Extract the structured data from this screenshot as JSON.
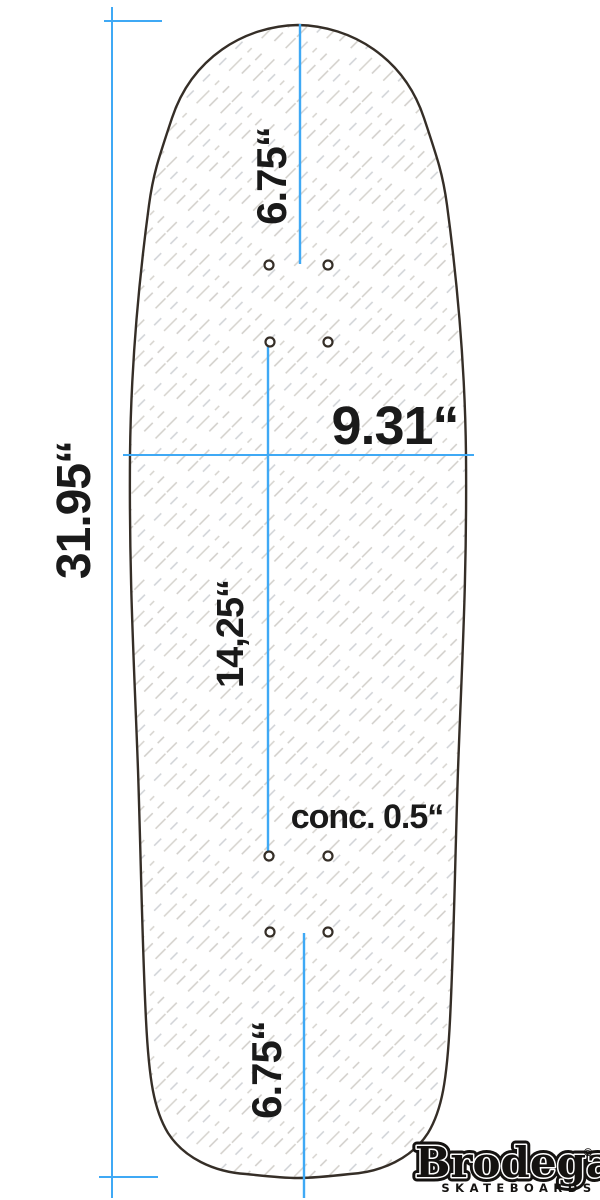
{
  "diagram": {
    "title": "skateboard-deck-dimension-drawing",
    "labels": {
      "total_length": "31.95“",
      "width": "9.31“",
      "nose_to_truck": "6.75“",
      "wheelbase": "14,25“",
      "concave": "conc. 0.5“",
      "tail_to_truck": "6.75“"
    },
    "colors": {
      "dimension_line": "#3fa9f5",
      "deck_outline": "#352e27",
      "hatch": "#d2cfca",
      "text": "#1a1a1a",
      "background": "#ffffff"
    }
  },
  "logo": {
    "brand": "Brodega",
    "registered": "®",
    "subtitle": "SKATEBOARDS"
  }
}
